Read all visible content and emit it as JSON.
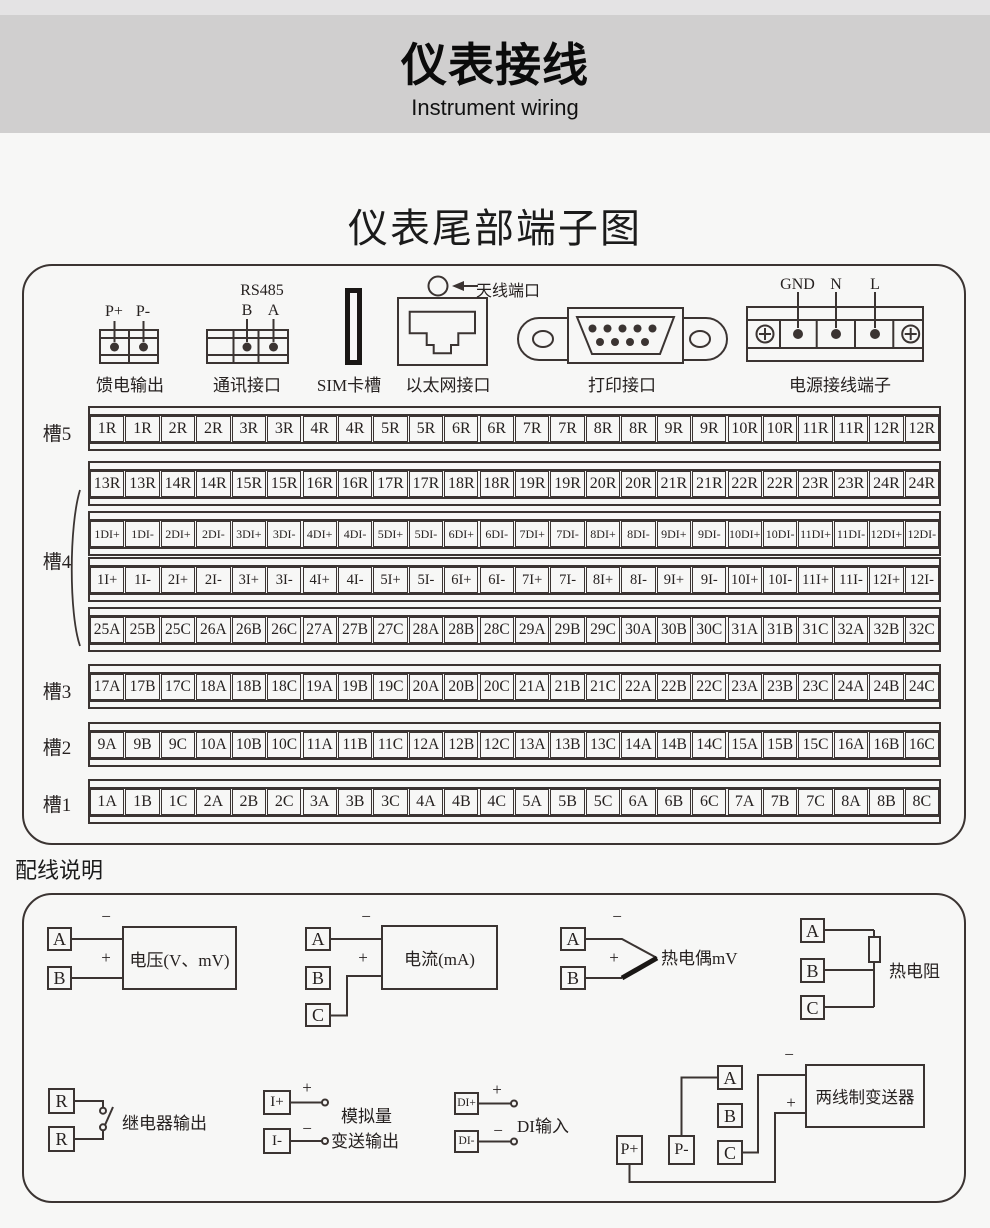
{
  "header": {
    "title": "仪表接线",
    "subtitle": "Instrument wiring",
    "band_color": "#d0cfcf"
  },
  "section_title": "仪表尾部端子图",
  "connectors": {
    "feed": {
      "pin_plus": "P+",
      "pin_minus": "P-",
      "label": "馈电输出"
    },
    "comm": {
      "title": "RS485",
      "pin_b": "B",
      "pin_a": "A",
      "label": "通讯接口"
    },
    "sim": {
      "label": "SIM卡槽"
    },
    "ethernet": {
      "label": "以太网接口"
    },
    "antenna": {
      "label": "天线端口"
    },
    "printer": {
      "label": "打印接口"
    },
    "power": {
      "pin_gnd": "GND",
      "pin_n": "N",
      "pin_l": "L",
      "label": "电源接线端子"
    }
  },
  "slots": {
    "labels": [
      "槽5",
      "槽4",
      "槽3",
      "槽2",
      "槽1"
    ],
    "strips": [
      {
        "cells": [
          "1R",
          "1R",
          "2R",
          "2R",
          "3R",
          "3R",
          "4R",
          "4R",
          "5R",
          "5R",
          "6R",
          "6R",
          "7R",
          "7R",
          "8R",
          "8R",
          "9R",
          "9R",
          "10R",
          "10R",
          "11R",
          "11R",
          "12R",
          "12R"
        ]
      },
      {
        "cells": [
          "13R",
          "13R",
          "14R",
          "14R",
          "15R",
          "15R",
          "16R",
          "16R",
          "17R",
          "17R",
          "18R",
          "18R",
          "19R",
          "19R",
          "20R",
          "20R",
          "21R",
          "21R",
          "22R",
          "22R",
          "23R",
          "23R",
          "24R",
          "24R"
        ]
      },
      {
        "cells": [
          "1DI+",
          "1DI-",
          "2DI+",
          "2DI-",
          "3DI+",
          "3DI-",
          "4DI+",
          "4DI-",
          "5DI+",
          "5DI-",
          "6DI+",
          "6DI-",
          "7DI+",
          "7DI-",
          "8DI+",
          "8DI-",
          "9DI+",
          "9DI-",
          "10DI+",
          "10DI-",
          "11DI+",
          "11DI-",
          "12DI+",
          "12DI-"
        ]
      },
      {
        "cells": [
          "1I+",
          "1I-",
          "2I+",
          "2I-",
          "3I+",
          "3I-",
          "4I+",
          "4I-",
          "5I+",
          "5I-",
          "6I+",
          "6I-",
          "7I+",
          "7I-",
          "8I+",
          "8I-",
          "9I+",
          "9I-",
          "10I+",
          "10I-",
          "11I+",
          "11I-",
          "12I+",
          "12I-"
        ]
      },
      {
        "cells": [
          "25A",
          "25B",
          "25C",
          "26A",
          "26B",
          "26C",
          "27A",
          "27B",
          "27C",
          "28A",
          "28B",
          "28C",
          "29A",
          "29B",
          "29C",
          "30A",
          "30B",
          "30C",
          "31A",
          "31B",
          "31C",
          "32A",
          "32B",
          "32C"
        ]
      },
      {
        "cells": [
          "17A",
          "17B",
          "17C",
          "18A",
          "18B",
          "18C",
          "19A",
          "19B",
          "19C",
          "20A",
          "20B",
          "20C",
          "21A",
          "21B",
          "21C",
          "22A",
          "22B",
          "22C",
          "23A",
          "23B",
          "23C",
          "24A",
          "24B",
          "24C"
        ]
      },
      {
        "cells": [
          "9A",
          "9B",
          "9C",
          "10A",
          "10B",
          "10C",
          "11A",
          "11B",
          "11C",
          "12A",
          "12B",
          "12C",
          "13A",
          "13B",
          "13C",
          "14A",
          "14B",
          "14C",
          "15A",
          "15B",
          "15C",
          "16A",
          "16B",
          "16C"
        ]
      },
      {
        "cells": [
          "1A",
          "1B",
          "1C",
          "2A",
          "2B",
          "2C",
          "3A",
          "3B",
          "3C",
          "4A",
          "4B",
          "4C",
          "5A",
          "5B",
          "5C",
          "6A",
          "6B",
          "6C",
          "7A",
          "7B",
          "7C",
          "8A",
          "8B",
          "8C"
        ]
      }
    ]
  },
  "wiring": {
    "title": "配线说明",
    "voltage": {
      "t1": "A",
      "t2": "B",
      "minus": "−",
      "plus": "+",
      "label": "电压(V、mV)"
    },
    "current": {
      "t1": "A",
      "t2": "B",
      "t3": "C",
      "minus": "−",
      "plus": "+",
      "label": "电流(mA)"
    },
    "thermocouple": {
      "t1": "A",
      "t2": "B",
      "minus": "−",
      "plus": "+",
      "label": "热电偶mV"
    },
    "rtd": {
      "t1": "A",
      "t2": "B",
      "t3": "C",
      "label": "热电阻"
    },
    "relay": {
      "t1": "R",
      "t2": "R",
      "label": "继电器输出"
    },
    "analog": {
      "t1": "I+",
      "t2": "I-",
      "plus": "+",
      "minus": "−",
      "label1": "模拟量",
      "label2": "变送输出"
    },
    "di": {
      "t1": "DI+",
      "t2": "DI-",
      "plus": "+",
      "minus": "−",
      "label": "DI输入"
    },
    "transmitter": {
      "tA": "A",
      "tB": "B",
      "tC": "C",
      "tPp": "P+",
      "tPm": "P-",
      "minus": "−",
      "plus": "+",
      "label": "两线制变送器"
    }
  }
}
